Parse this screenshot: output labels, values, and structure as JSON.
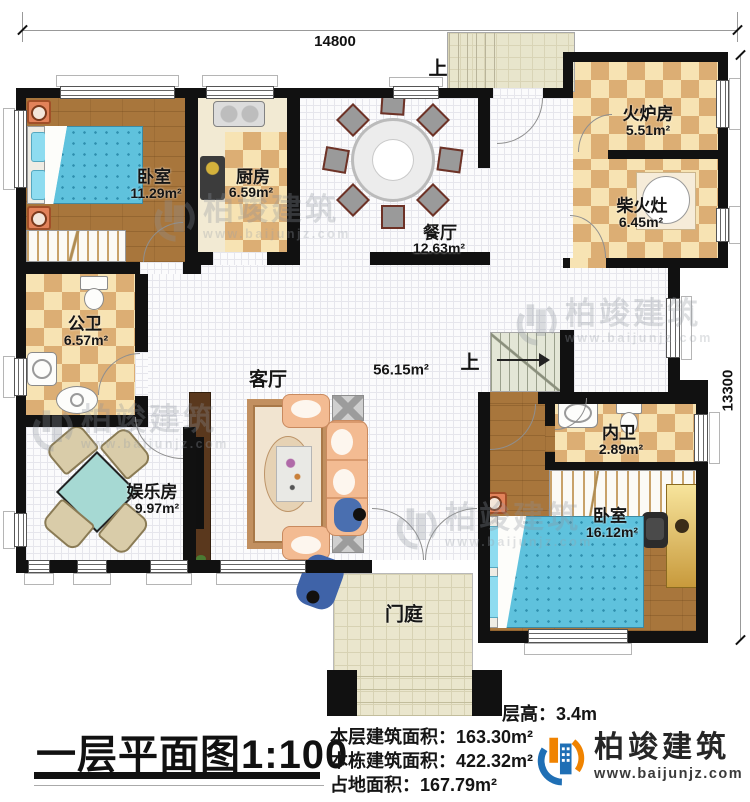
{
  "dimensions": {
    "width_label": "14800",
    "height_label": "13300"
  },
  "stairs": {
    "up_top": "上",
    "up_mid": "上"
  },
  "rooms": {
    "bedroom1": {
      "name": "卧室",
      "area": "11.29m²"
    },
    "kitchen": {
      "name": "厨房",
      "area": "6.59m²"
    },
    "dining": {
      "name": "餐厅",
      "area": "12.63m²"
    },
    "furnace": {
      "name": "火炉房",
      "area": "5.51m²"
    },
    "firewood": {
      "name": "柴火灶",
      "area": "6.45m²"
    },
    "public_bath": {
      "name": "公卫",
      "area": "6.57m²"
    },
    "living": {
      "name": "客厅",
      "area": "56.15m²"
    },
    "entertainment": {
      "name": "娱乐房",
      "area": "9.97m²"
    },
    "inner_bath": {
      "name": "内卫",
      "area": "2.89m²"
    },
    "bedroom2": {
      "name": "卧室",
      "area": "16.12m²"
    },
    "porch": {
      "name": "门庭"
    }
  },
  "title": "一层平面图1:100",
  "info": {
    "floor_height": "层高：3.4m",
    "floor_area": "本层建筑面积：163.30m²",
    "building_area": "本栋建筑面积：422.32m²",
    "land_area": "占地面积：167.79m²"
  },
  "brand": {
    "name": "柏竣建筑",
    "url": "www.baijunjz.com"
  },
  "colors": {
    "wall": "#111111",
    "accent_orange": "#f08300",
    "accent_blue": "#1f6fb5"
  }
}
